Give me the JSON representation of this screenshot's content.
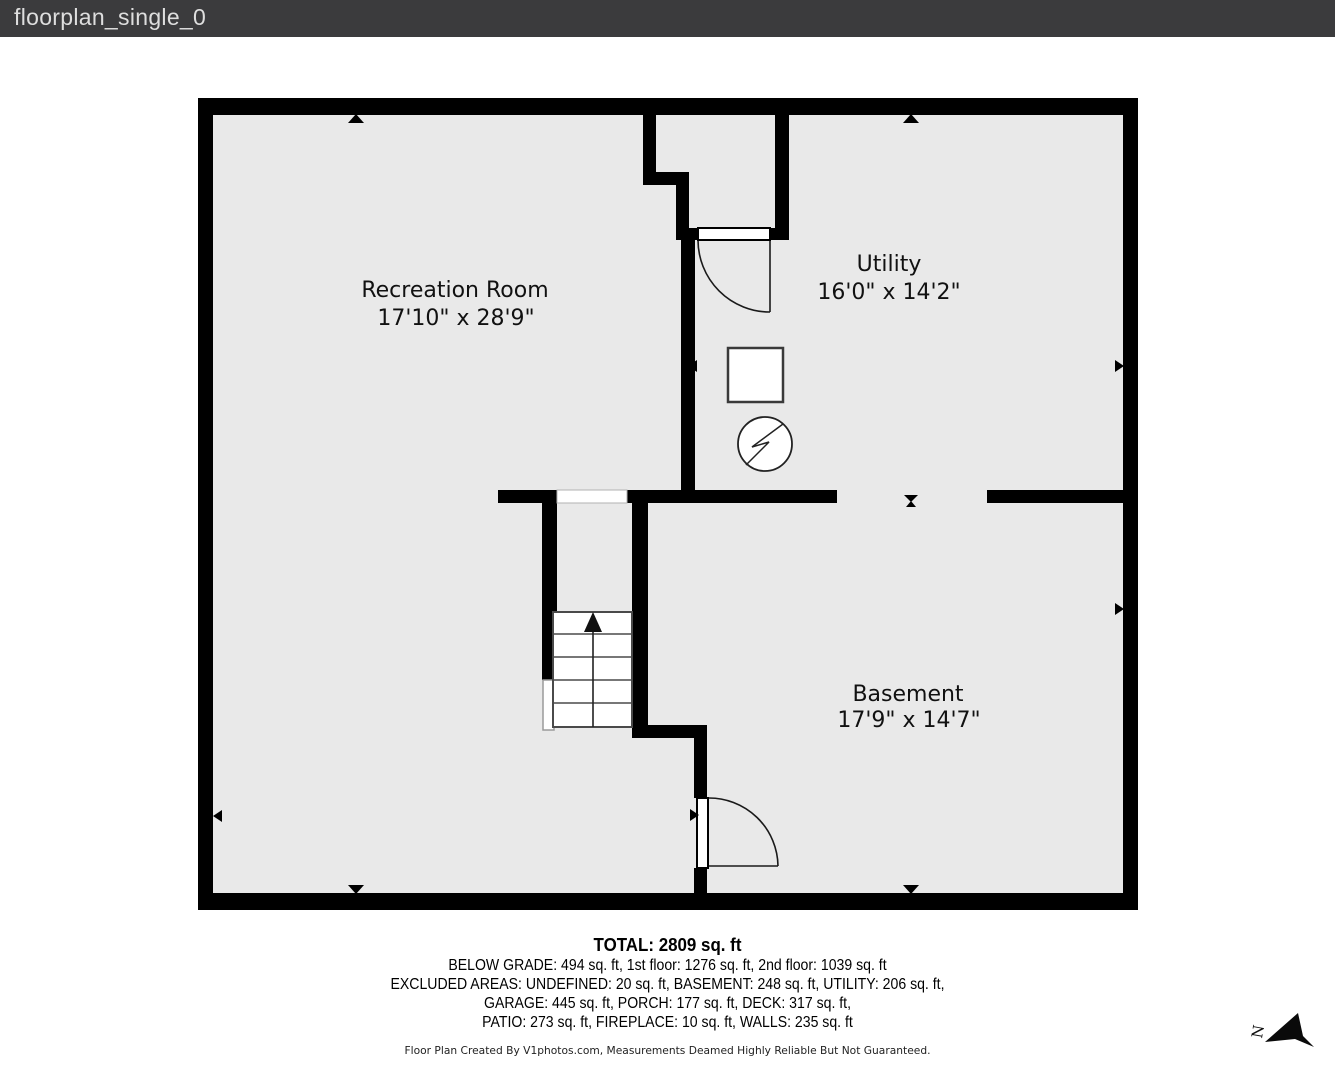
{
  "header": {
    "title": "floorplan_single_0"
  },
  "floorplan": {
    "rooms": [
      {
        "name": "Recreation Room",
        "dims": "17'10\" x 28'9\""
      },
      {
        "name": "Utility",
        "dims": "16'0\" x 14'2\""
      },
      {
        "name": "Basement",
        "dims": "17'9\" x 14'7\""
      }
    ],
    "compass": {
      "label": "N"
    },
    "symbols": [
      "furnace-square",
      "water-heater-circle-zigzag",
      "stairs-up-arrow",
      "door-swing-arc",
      "window-opening",
      "wall-marker-triangles"
    ]
  },
  "summary": {
    "total": "TOTAL: 2809 sq. ft",
    "line1": "BELOW GRADE: 494 sq. ft, 1st floor: 1276 sq. ft, 2nd floor: 1039 sq. ft",
    "line2": "EXCLUDED AREAS: UNDEFINED: 20 sq. ft, BASEMENT: 248 sq. ft, UTILITY: 206 sq. ft,",
    "line3": "GARAGE: 445 sq. ft, PORCH: 177 sq. ft, DECK: 317 sq. ft,",
    "line4": "PATIO: 273 sq. ft, FIREPLACE: 10 sq. ft, WALLS: 235 sq. ft",
    "disclaimer": "Floor Plan Created By V1photos.com, Measurements Deamed Highly Reliable But Not Guaranteed.",
    "areas": [
      {
        "name": "TOTAL",
        "sqft": 2809
      },
      {
        "name": "BELOW GRADE",
        "sqft": 494
      },
      {
        "name": "1st floor",
        "sqft": 1276
      },
      {
        "name": "2nd floor",
        "sqft": 1039
      },
      {
        "name": "UNDEFINED (excluded)",
        "sqft": 20
      },
      {
        "name": "BASEMENT (excluded)",
        "sqft": 248
      },
      {
        "name": "UTILITY (excluded)",
        "sqft": 206
      },
      {
        "name": "GARAGE",
        "sqft": 445
      },
      {
        "name": "PORCH",
        "sqft": 177
      },
      {
        "name": "DECK",
        "sqft": 317
      },
      {
        "name": "PATIO",
        "sqft": 273
      },
      {
        "name": "FIREPLACE",
        "sqft": 10
      },
      {
        "name": "WALLS",
        "sqft": 235
      }
    ]
  },
  "colors": {
    "titlebar_bg": "#3b3b3d",
    "titlebar_text": "#dedede",
    "wall": "#000000",
    "floor": "#e9e9e9",
    "page_bg": "#ffffff",
    "stair_stroke": "#4a4a4a"
  }
}
